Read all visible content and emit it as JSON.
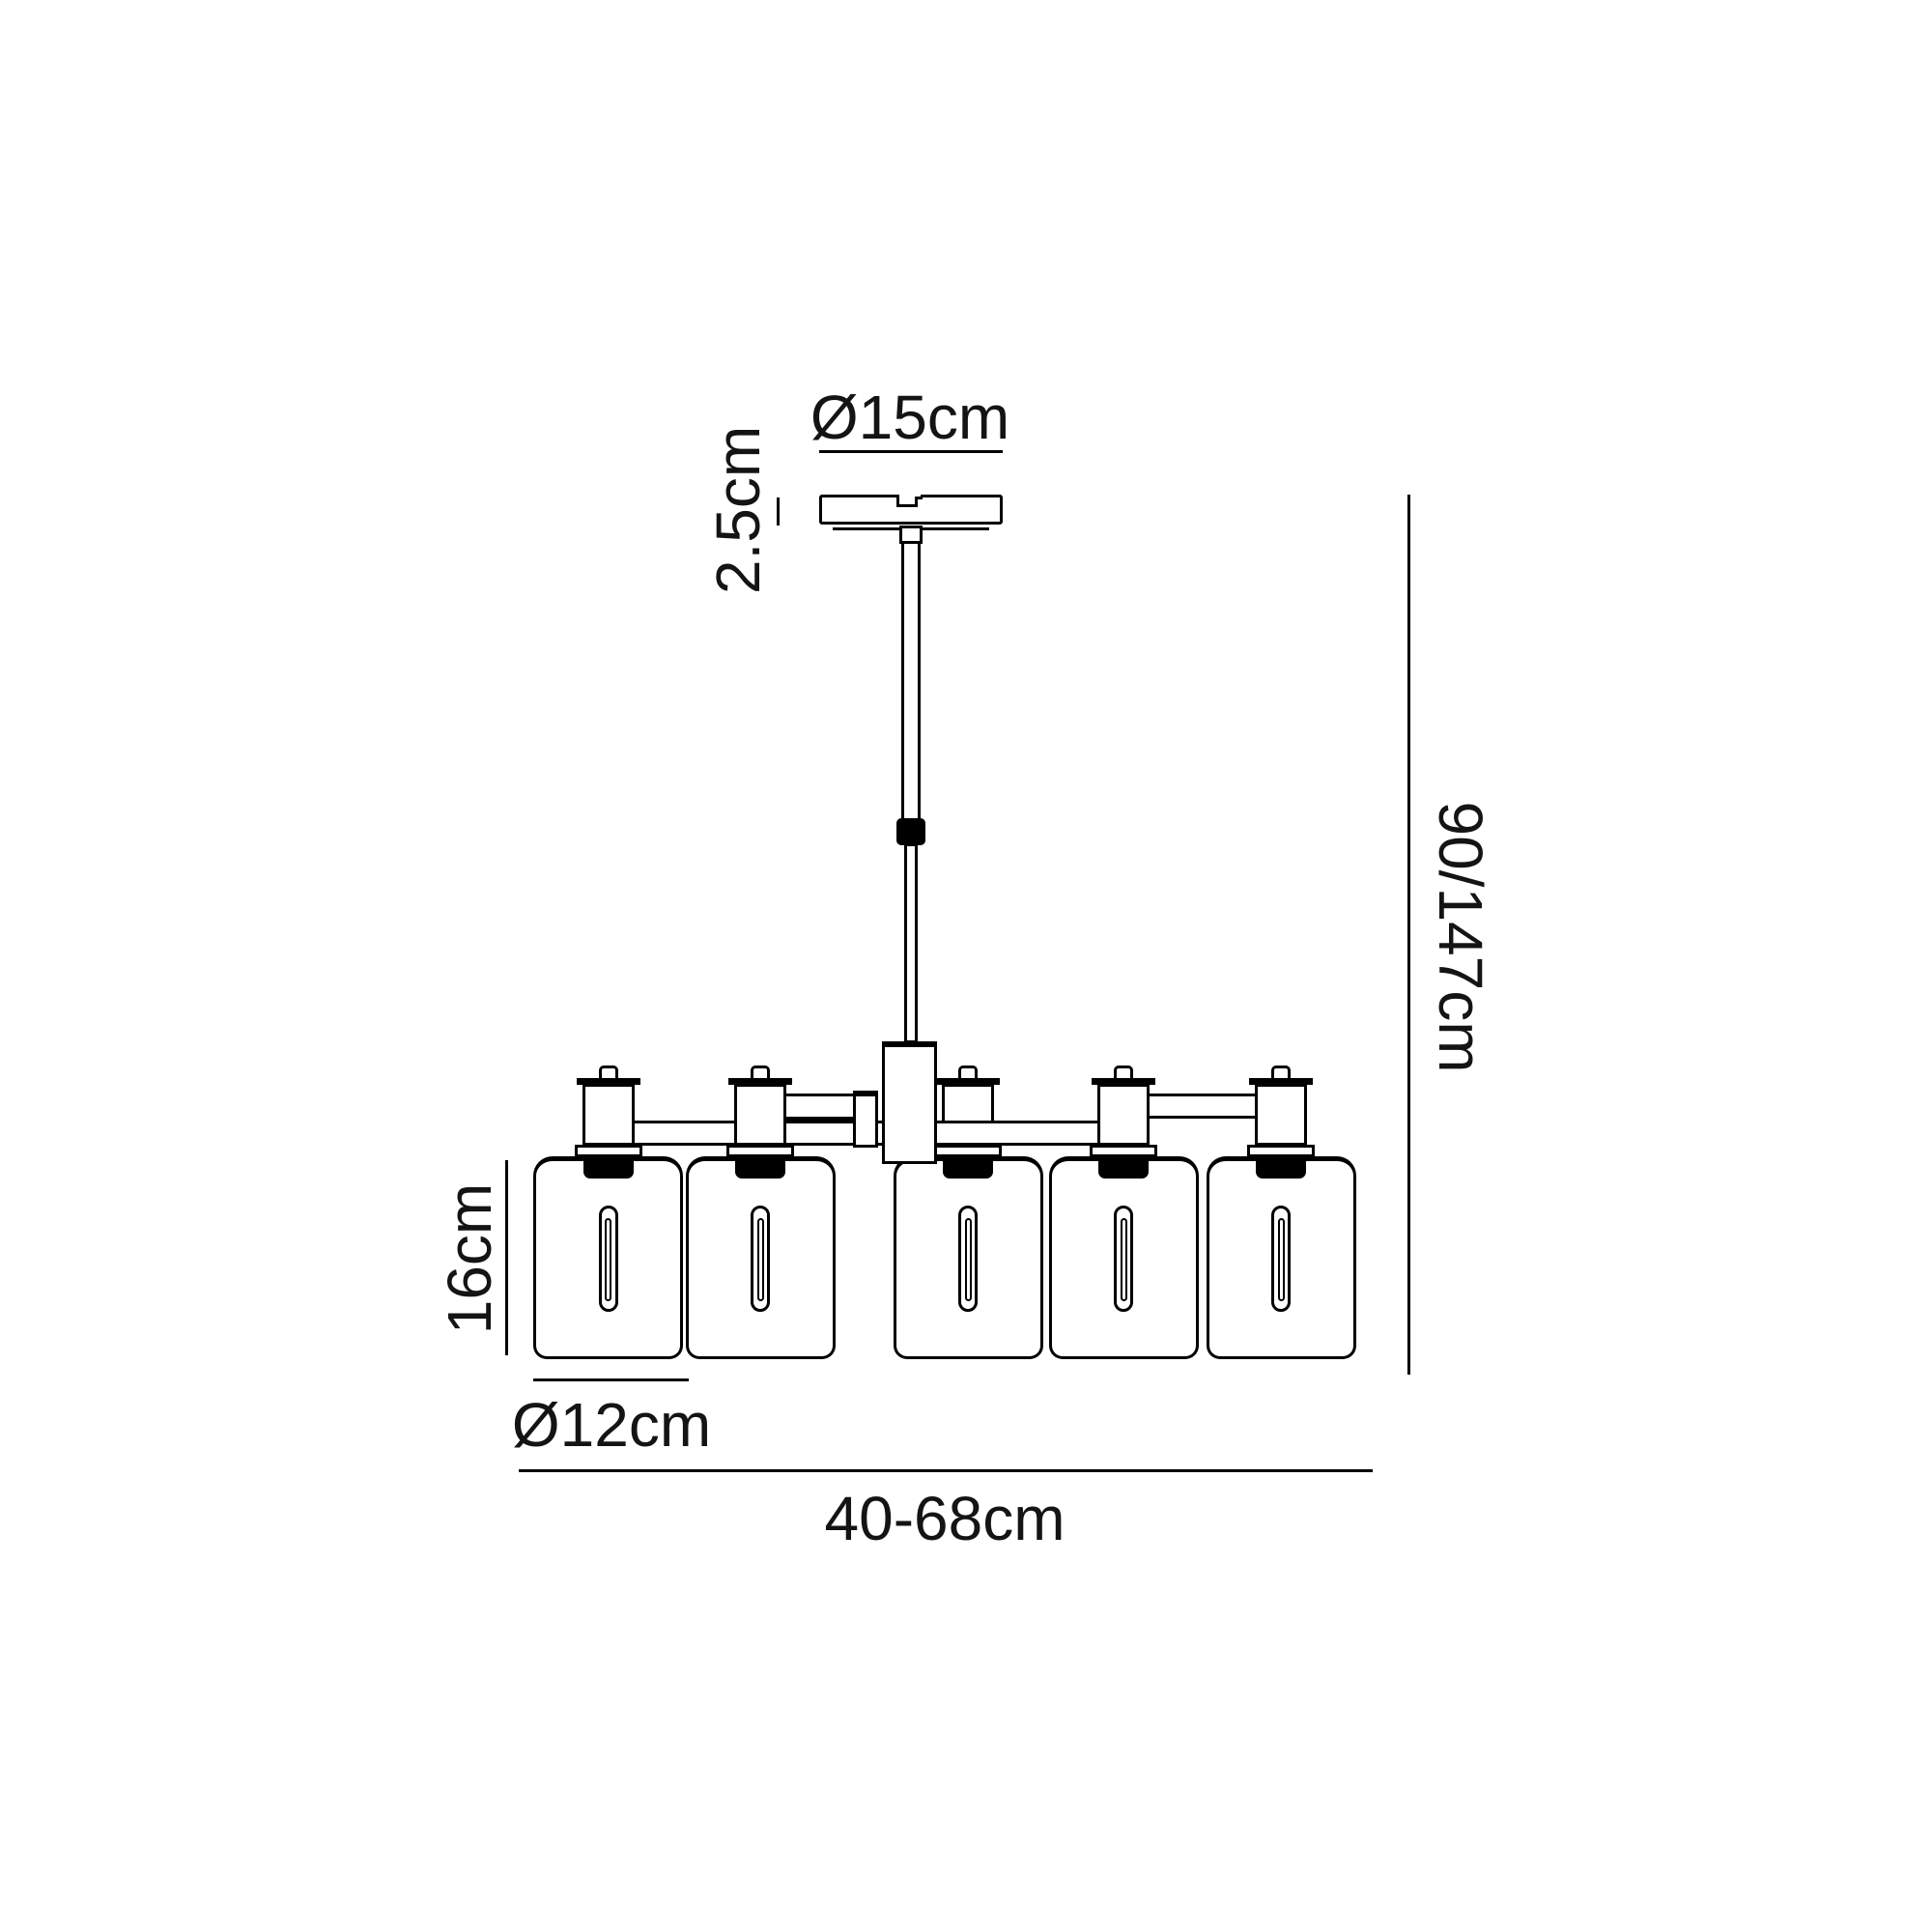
{
  "fixture": {
    "lights_count": 5
  },
  "dimensions": {
    "canopy_diameter": "Ø15cm",
    "canopy_height": "2.5cm",
    "overall_height": "90/147cm",
    "shade_height": "16cm",
    "shade_diameter": "Ø12cm",
    "overall_width": "40-68cm"
  },
  "colors": {
    "background": "#ffffff",
    "line": "#000000",
    "text": "#141414"
  }
}
